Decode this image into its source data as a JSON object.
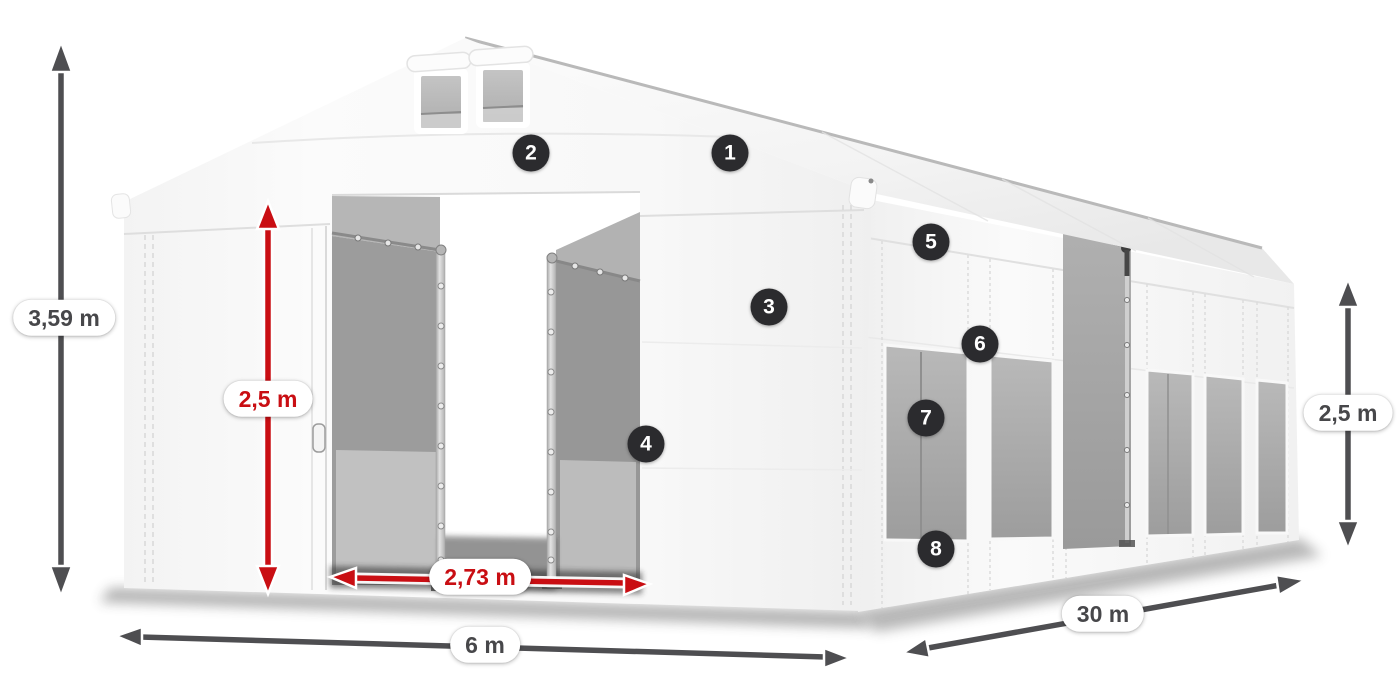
{
  "annotations": {
    "total_height": {
      "text": "3,59 m",
      "style": "dark"
    },
    "door_height": {
      "text": "2,5 m",
      "style": "red"
    },
    "door_width": {
      "text": "2,73 m",
      "style": "red"
    },
    "front_width": {
      "text": "6 m",
      "style": "dark"
    },
    "side_length": {
      "text": "30 m",
      "style": "dark"
    },
    "side_height": {
      "text": "2,5 m",
      "style": "dark"
    }
  },
  "callouts": {
    "items": [
      "1",
      "2",
      "3",
      "4",
      "5",
      "6",
      "7",
      "8"
    ]
  },
  "colors": {
    "dimension_dark": "#4e4e51",
    "dimension_red": "#c90e13",
    "pill_background": "#ffffff",
    "badge_background": "#2b2b2e",
    "badge_text": "#ffffff",
    "tent_white": "#f7f7f7",
    "window_gray": "#a8a8a8"
  }
}
